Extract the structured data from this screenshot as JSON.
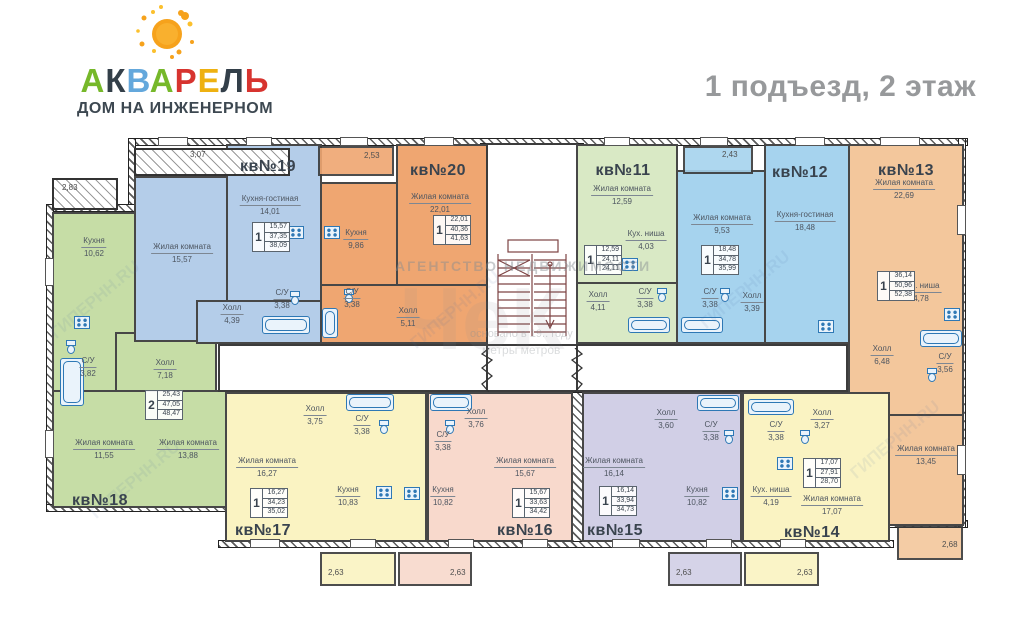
{
  "header": {
    "brand_letters": [
      {
        "ch": "А",
        "color": "#76b82a"
      },
      {
        "ch": "К",
        "color": "#333f49"
      },
      {
        "ch": "В",
        "color": "#64a8dc"
      },
      {
        "ch": "А",
        "color": "#76b82a"
      },
      {
        "ch": "Р",
        "color": "#d7342f"
      },
      {
        "ch": "Е",
        "color": "#eeb111"
      },
      {
        "ch": "Л",
        "color": "#333f49"
      },
      {
        "ch": "Ь",
        "color": "#d7342f"
      }
    ],
    "subtitle": "ДОМ НА ИНЖЕНЕРНОМ",
    "floor_title": "1 подъезд, 2 этаж"
  },
  "watermarks": {
    "agency": "АГЕНТСТВО НЕДВИЖИМОСТИ",
    "agency_big": "ЧеК",
    "founded": "основано в 19.. году",
    "slogan": "метры метров",
    "site": "ГИПЕРНН.RU"
  },
  "apartments": {
    "kv11": {
      "number": "кв№11",
      "color": "#d9e9c5",
      "info": {
        "rooms": "1",
        "living": "12,59",
        "total": "24,11",
        "total_with_balcony": "24,11"
      },
      "rooms": [
        {
          "name": "Жилая комната",
          "area": "12,59"
        },
        {
          "name": "Кух. ниша",
          "area": "4,03"
        },
        {
          "name": "Холл",
          "area": "4,11"
        },
        {
          "name": "С/У",
          "area": "3,38"
        }
      ]
    },
    "kv12": {
      "number": "кв№12",
      "color": "#a6d3ee",
      "balcony_dim": "2,43",
      "info": {
        "rooms": "1",
        "living": "18,48",
        "total": "34,78",
        "total_with_balcony": "35,99"
      },
      "rooms": [
        {
          "name": "Жилая комната",
          "area": "9,53"
        },
        {
          "name": "Кухня-гостиная",
          "area": "18,48"
        },
        {
          "name": "С/У",
          "area": "3,38"
        },
        {
          "name": "Холл",
          "area": "3,39"
        }
      ]
    },
    "kv13": {
      "number": "кв№13",
      "color": "#f3c79c",
      "balcony_dim": "2,68",
      "info": {
        "rooms": "1",
        "living": "36,14",
        "total": "50,96",
        "total_with_balcony": "52,38"
      },
      "rooms": [
        {
          "name": "Жилая комната",
          "area": "22,69"
        },
        {
          "name": "Кух. ниша",
          "area": "4,78"
        },
        {
          "name": "Холл",
          "area": "6,48"
        },
        {
          "name": "С/У",
          "area": "3,56"
        },
        {
          "name": "Жилая комната",
          "area": "13,45"
        }
      ]
    },
    "kv14": {
      "number": "кв№14",
      "color": "#faf3c2",
      "balcony_dim": "2,63",
      "info": {
        "rooms": "1",
        "living": "17,07",
        "total": "27,91",
        "total_with_balcony": "28,70"
      },
      "rooms": [
        {
          "name": "С/У",
          "area": "3,38"
        },
        {
          "name": "Холл",
          "area": "3,27"
        },
        {
          "name": "Кух. ниша",
          "area": "4,19"
        },
        {
          "name": "Жилая комната",
          "area": "17,07"
        }
      ]
    },
    "kv15": {
      "number": "кв№15",
      "color": "#d1cfe6",
      "balcony_dim": "2,63",
      "info": {
        "rooms": "1",
        "living": "16,14",
        "total": "33,94",
        "total_with_balcony": "34,73"
      },
      "rooms": [
        {
          "name": "Жилая комната",
          "area": "16,14"
        },
        {
          "name": "Холл",
          "area": "3,60"
        },
        {
          "name": "С/У",
          "area": "3,38"
        },
        {
          "name": "Кухня",
          "area": "10,82"
        }
      ]
    },
    "kv16": {
      "number": "кв№16",
      "color": "#f8d9cc",
      "balcony_dim": "2,63",
      "info": {
        "rooms": "1",
        "living": "15,67",
        "total": "33,63",
        "total_with_balcony": "34,42"
      },
      "rooms": [
        {
          "name": "Жилая комната",
          "area": "15,67"
        },
        {
          "name": "Холл",
          "area": "3,76"
        },
        {
          "name": "С/У",
          "area": "3,38"
        },
        {
          "name": "Кухня",
          "area": "10,82"
        }
      ]
    },
    "kv17": {
      "number": "кв№17",
      "color": "#faf3c2",
      "balcony_dim": "2,63",
      "info": {
        "rooms": "1",
        "living": "16,27",
        "total": "34,23",
        "total_with_balcony": "35,02"
      },
      "rooms": [
        {
          "name": "Жилая комната",
          "area": "16,27"
        },
        {
          "name": "Кухня",
          "area": "10,83"
        },
        {
          "name": "Холл",
          "area": "3,75"
        },
        {
          "name": "С/У",
          "area": "3,38"
        }
      ]
    },
    "kv18": {
      "number": "кв№18",
      "color": "#c6dda6",
      "balcony_dim": "2,83",
      "info": {
        "rooms": "2",
        "living": "25,43",
        "total": "47,05",
        "total_with_balcony": "48,47"
      },
      "rooms": [
        {
          "name": "Кухня",
          "area": "10,62"
        },
        {
          "name": "С/У",
          "area": "3,82"
        },
        {
          "name": "Холл",
          "area": "7,18"
        },
        {
          "name": "Жилая комната",
          "area": "11,55"
        },
        {
          "name": "Жилая комната",
          "area": "13,88"
        }
      ]
    },
    "kv19": {
      "number": "кв№19",
      "color": "#b4cde9",
      "balcony_dim": "3,07",
      "info": {
        "rooms": "1",
        "living": "15,57",
        "total": "37,35",
        "total_with_balcony": "38,09"
      },
      "rooms": [
        {
          "name": "Кухня-гостиная",
          "area": "14,01"
        },
        {
          "name": "Жилая комната",
          "area": "15,57"
        },
        {
          "name": "Холл",
          "area": "4,39"
        },
        {
          "name": "С/У",
          "area": "3,38"
        }
      ]
    },
    "kv20": {
      "number": "кв№20",
      "color": "#efa671",
      "balcony_dim": "2,53",
      "info": {
        "rooms": "1",
        "living": "22,01",
        "total": "40,36",
        "total_with_balcony": "41,63"
      },
      "rooms": [
        {
          "name": "Жилая комната",
          "area": "22,01"
        },
        {
          "name": "Кухня",
          "area": "9,86"
        },
        {
          "name": "С/У",
          "area": "3,38"
        },
        {
          "name": "Холл",
          "area": "5,11"
        }
      ]
    }
  }
}
